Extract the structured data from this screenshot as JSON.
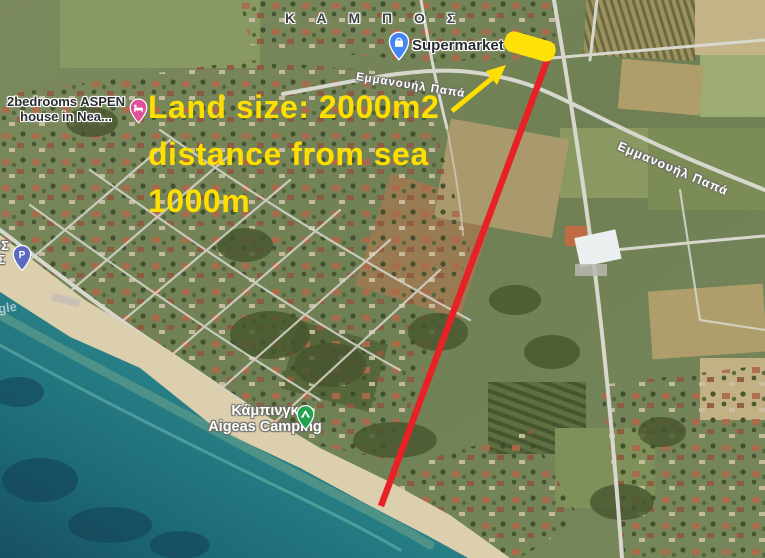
{
  "area_label": "Κ Α Μ Π Ο Σ",
  "street_labels": {
    "top": "Εμμανουήλ Παπά",
    "right": "Εμμανουήλ Παπά"
  },
  "annotation": {
    "line1": "Land size: 2000m2",
    "line2": "distance from sea",
    "line3": "1000m",
    "text_color": "#ffdf00",
    "highlight_color": "#ffe10a",
    "red_line_color": "#e82127"
  },
  "pois": {
    "supermarket": {
      "label": "Supermarket Πα",
      "pin_color": "#4285f4"
    },
    "aspen": {
      "line1": "2bedrooms ASPEN",
      "line2": "house in Nea...",
      "pin_color": "#e0519b"
    },
    "camping": {
      "line1": "Κάμπινγκ",
      "line2": "Aigeas Camping",
      "pin_color": "#23a14f"
    },
    "parking": {
      "glyph": "P",
      "pin_color": "#5c6bc0"
    }
  },
  "edge_labels": {
    "line1": "ΟΣ",
    "line2": "ΑΣ"
  },
  "watermark_fragment": "gle"
}
